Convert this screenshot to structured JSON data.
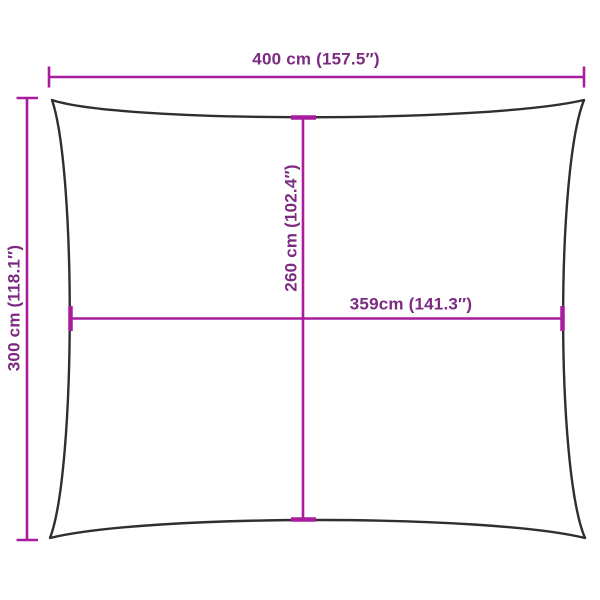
{
  "diagram": {
    "kind": "product-dimension-diagram",
    "shape": "rectangular-shade-sail-outline",
    "colors": {
      "dimension_line": "#a81c9e",
      "dimension_text": "#7b2b80",
      "outline": "#2f2f2f",
      "background": "#ffffff"
    },
    "dimensions": {
      "top_width": {
        "label": "400 cm (157.5″)",
        "value_cm": 400,
        "value_in": 157.5
      },
      "left_height": {
        "label": "300 cm (118.1″)",
        "value_cm": 300,
        "value_in": 118.1
      },
      "center_vertical": {
        "label": "260 cm (102.4″)",
        "value_cm": 260,
        "value_in": 102.4
      },
      "center_horizontal": {
        "label": "359cm (141.3″)",
        "value_cm": 359,
        "value_in": 141.3
      }
    }
  }
}
